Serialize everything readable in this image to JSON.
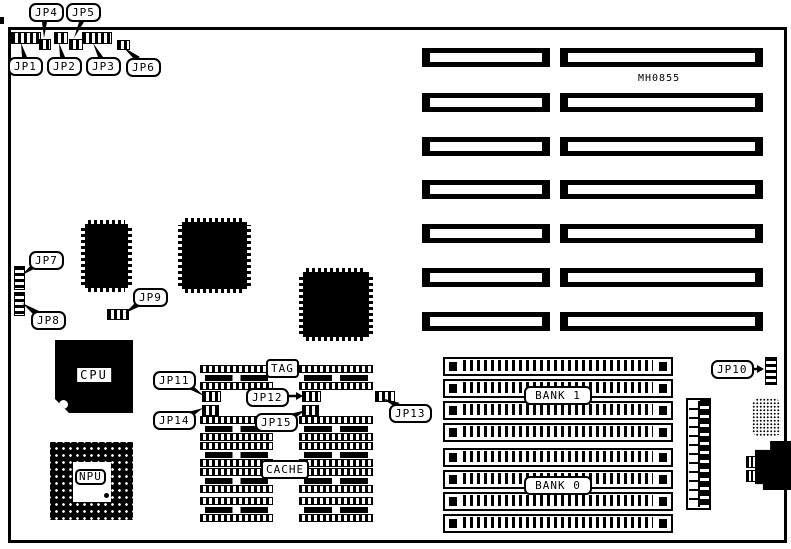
{
  "part_number": "MH0855",
  "callouts": {
    "jp1": "JP1",
    "jp2": "JP2",
    "jp3": "JP3",
    "jp4": "JP4",
    "jp5": "JP5",
    "jp6": "JP6",
    "jp7": "JP7",
    "jp8": "JP8",
    "jp9": "JP9",
    "jp10": "JP10",
    "jp11": "JP11",
    "jp12": "JP12",
    "jp13": "JP13",
    "jp14": "JP14",
    "jp15": "JP15"
  },
  "chips": {
    "cpu": "CPU",
    "npu": "NPU",
    "tag": "TAG",
    "cache": "CACHE"
  },
  "memory": {
    "bank1": "BANK 1",
    "bank0": "BANK 0"
  }
}
